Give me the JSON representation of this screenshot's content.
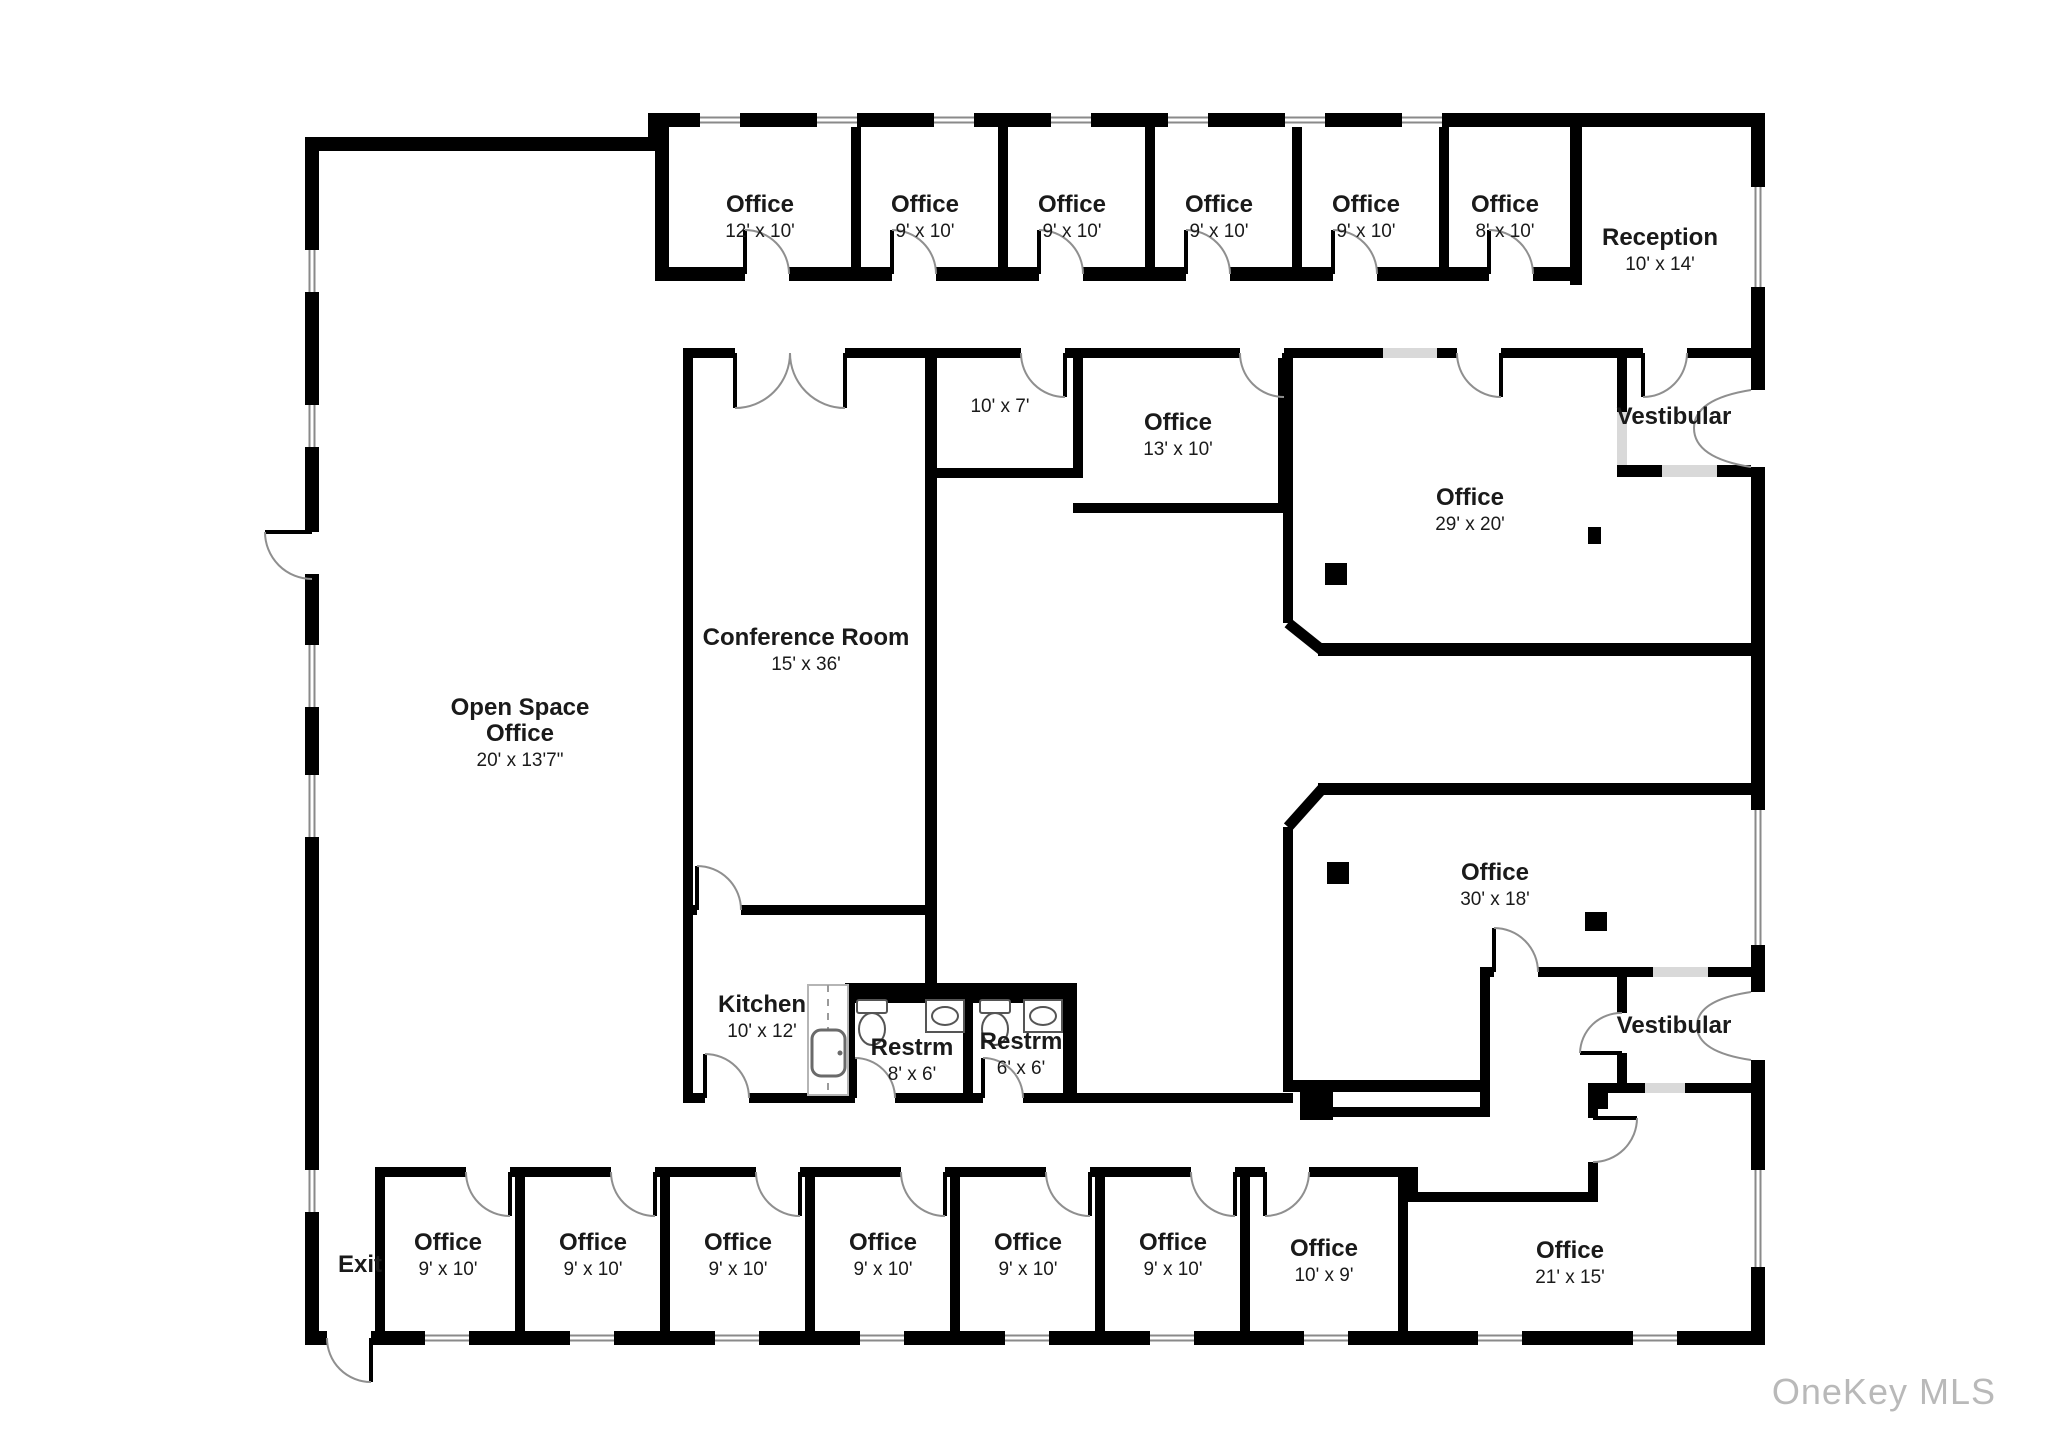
{
  "watermark": "OneKey MLS",
  "colors": {
    "wall": "#000000",
    "door_arc": "#8f8f8f",
    "glass": "#d9d9d9",
    "watermark": "#b9b9b9",
    "background": "#ffffff"
  },
  "rooms": {
    "top_offices": [
      {
        "label": "Office",
        "dims": "12' x 10'"
      },
      {
        "label": "Office",
        "dims": "9' x 10'"
      },
      {
        "label": "Office",
        "dims": "9' x 10'"
      },
      {
        "label": "Office",
        "dims": "9' x 10'"
      },
      {
        "label": "Office",
        "dims": "9' x 10'"
      },
      {
        "label": "Office",
        "dims": "8' x 10'"
      }
    ],
    "reception": {
      "label": "Reception",
      "dims": "10' x 14'"
    },
    "nook": {
      "dims": "10' x 7'"
    },
    "office_13": {
      "label": "Office",
      "dims": "13' x 10'"
    },
    "office_29": {
      "label": "Office",
      "dims": "29' x 20'"
    },
    "vestibular_top": {
      "label": "Vestibular"
    },
    "conference": {
      "label": "Conference Room",
      "dims": "15' x 36'"
    },
    "open_space": {
      "label_line1": "Open Space",
      "label_line2": "Office",
      "dims": "20' x 13'7\""
    },
    "kitchen": {
      "label": "Kitchen",
      "dims": "10' x 12'"
    },
    "restroom_1": {
      "label": "Restrm",
      "dims": "8' x 6'"
    },
    "restroom_2": {
      "label": "Restrm",
      "dims": "6' x 6'"
    },
    "office_30": {
      "label": "Office",
      "dims": "30' x 18'"
    },
    "vestibular_bottom": {
      "label": "Vestibular"
    },
    "exit": {
      "label": "Exit"
    },
    "bottom_offices": [
      {
        "label": "Office",
        "dims": "9' x 10'"
      },
      {
        "label": "Office",
        "dims": "9' x 10'"
      },
      {
        "label": "Office",
        "dims": "9' x 10'"
      },
      {
        "label": "Office",
        "dims": "9' x 10'"
      },
      {
        "label": "Office",
        "dims": "9' x 10'"
      },
      {
        "label": "Office",
        "dims": "9' x 10'"
      }
    ],
    "office_10x9": {
      "label": "Office",
      "dims": "10' x 9'"
    },
    "office_21": {
      "label": "Office",
      "dims": "21' x 15'"
    }
  }
}
